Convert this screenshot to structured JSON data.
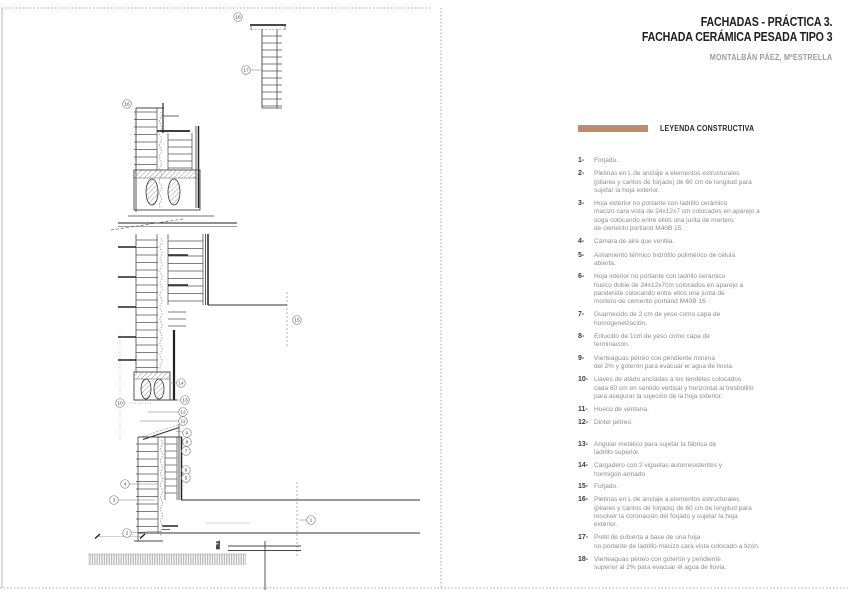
{
  "title_block": {
    "line1": "FACHADAS - PRÁCTICA 3.",
    "line2": "FACHADA CERÁMICA PESADA TIPO 3",
    "author": "MONTALBÁN PÁEZ, MªESTRELLA"
  },
  "legend": {
    "title": "LEYENDA CONSTRUCTIVA",
    "accent_color": "#bb8c6e",
    "items": [
      {
        "n": "1-",
        "lines": [
          "Forjado."
        ]
      },
      {
        "n": "2-",
        "lines": [
          "Pletinas en L de anclaje a elementos estructurales",
          "(pilares y cantos de forjado) de 60 cm de longitud para",
          "sujetar la hoja exterior."
        ]
      },
      {
        "n": "3-",
        "lines": [
          "Hoja exterior no portante con ladrillo cerámico",
          "macizo cara vista de 24x12x7 cm colocados en aparejo a",
          "soga colocando entre ellos una junta de mortero",
          "de cemento portland M40B 15."
        ]
      },
      {
        "n": "4-",
        "lines": [
          "Cámara de aire que ventila."
        ]
      },
      {
        "n": "5-",
        "lines": [
          "Aislamiento térmico hidrófilo polimérico de célula",
          "abierta."
        ]
      },
      {
        "n": "6-",
        "lines": [
          "Hoja interior no portante con ladrillo cerámico",
          "hueco doble de 24x12x7cm colocados en aparejo a",
          "panderete colocando entre ellos una junta de",
          "mortero de cemento portland M40B 16."
        ]
      },
      {
        "n": "7-",
        "lines": [
          "Guarnecido de 2 cm de yeso como capa de",
          "homogeneización."
        ]
      },
      {
        "n": "8-",
        "lines": [
          "Enlucido de 1cm de yeso como capa de",
          "terminación."
        ]
      },
      {
        "n": "9-",
        "lines": [
          "Vierteaguas pétreo con pendiente mínima",
          "del 2% y goterón para evacuar el agua de lluvia."
        ]
      },
      {
        "n": "10-",
        "lines": [
          "Llaves de atado ancladas a los tendeles colocados",
          "cada 60 cm en sentido vertical y horizontal al tresbolillo",
          "para asegurar la sujeción de la hoja exterior."
        ]
      },
      {
        "n": "11-",
        "lines": [
          "Hueco de ventana."
        ]
      },
      {
        "n": "12-",
        "lines": [
          "Dintel pétreo."
        ]
      },
      {
        "n": "13-",
        "lines": [
          "Angular metálico para sujetar la fábrica de",
          "ladrillo superior."
        ]
      },
      {
        "n": "14-",
        "lines": [
          "Cargadero con 2 viguetas autorresistentes y",
          "hormigón armado"
        ]
      },
      {
        "n": "15-",
        "lines": [
          "Forjado."
        ]
      },
      {
        "n": "16-",
        "lines": [
          "Pletinas en L de anclaje a elementos estructurales",
          "(pilares y cantos de forjado) de 60 cm de longitud para",
          "resolver la coronación del forjado y sujetar la hoja",
          "exterior."
        ]
      },
      {
        "n": "17-",
        "lines": [
          "Pretil de cubierta a base de una hoja",
          "no portante de ladrillo macizo cara vista colocado a tizón."
        ]
      },
      {
        "n": "18-",
        "lines": [
          "Vierteaguas pétreo con goterón y pendiente",
          "superior al 2% para evacuar el agua de lluvia."
        ]
      }
    ]
  },
  "drawing": {
    "dimension_label": "50.1",
    "callouts": [
      {
        "n": "18",
        "x": 238,
        "y": 17
      },
      {
        "n": "17",
        "x": 246,
        "y": 70,
        "lx": 262,
        "ly": 70
      },
      {
        "n": "16",
        "x": 127,
        "y": 104
      },
      {
        "n": "15",
        "x": 297,
        "y": 320
      },
      {
        "n": "14",
        "x": 181,
        "y": 383,
        "lx": 171,
        "ly": 383
      },
      {
        "n": "13",
        "x": 185,
        "y": 400,
        "lx": 177,
        "ly": 400
      },
      {
        "n": "12",
        "x": 183,
        "y": 412,
        "lx": 148,
        "ly": 412
      },
      {
        "n": "11",
        "x": 183,
        "y": 421,
        "lx": 140,
        "ly": 421
      },
      {
        "n": "10",
        "x": 120,
        "y": 403,
        "lx": 152,
        "ly": 403,
        "dotted": true
      },
      {
        "n": "9",
        "x": 187,
        "y": 433,
        "lx": 176,
        "ly": 431
      },
      {
        "n": "8",
        "x": 187,
        "y": 442
      },
      {
        "n": "7",
        "x": 186,
        "y": 451
      },
      {
        "n": "6",
        "x": 186,
        "y": 470
      },
      {
        "n": "5",
        "x": 186,
        "y": 478
      },
      {
        "n": "4",
        "x": 125,
        "y": 484,
        "lx": 158,
        "ly": 484
      },
      {
        "n": "3",
        "x": 114,
        "y": 500,
        "lx": 155,
        "ly": 500
      },
      {
        "n": "2",
        "x": 127,
        "y": 533,
        "lx": 162,
        "ly": 531
      },
      {
        "n": "1",
        "x": 311,
        "y": 520,
        "lx": 299,
        "ly": 520
      }
    ]
  }
}
